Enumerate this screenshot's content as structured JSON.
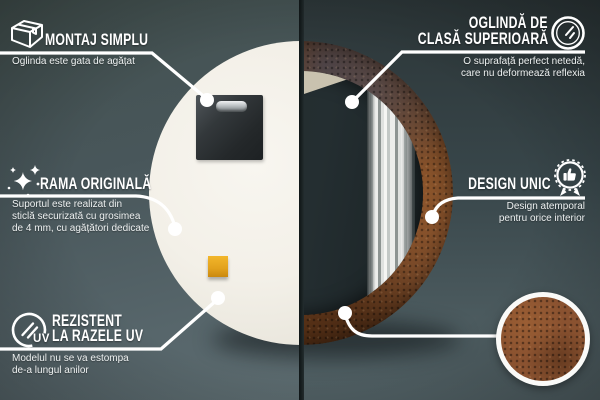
{
  "callouts": {
    "montaj": {
      "title": "MONTAJ SIMPLU",
      "desc": "Oglinda este gata de agățat",
      "icon": "package-box-icon"
    },
    "premium": {
      "title_line1": "OGLINDĂ DE",
      "title_line2": "CLASĂ SUPERIOARĂ",
      "desc_line1": "O suprafață perfect netedă,",
      "desc_line2": "care nu deformează reflexia",
      "icon": "mirror-shine-icon"
    },
    "rama": {
      "title": "RAMA ORIGINALĂ",
      "desc_line1": "Suportul este realizat din",
      "desc_line2": "sticlă securizată cu grosimea",
      "desc_line3": "de 4 mm, cu agățători dedicate",
      "icon": "sparkles-icon"
    },
    "design": {
      "title": "DESIGN UNIC",
      "desc_line1": "Design atemporal",
      "desc_line2": "pentru orice interior",
      "icon": "award-badge-icon"
    },
    "uv": {
      "title_line1": "REZISTENT",
      "title_line2": "LA RAZELE UV",
      "desc_line1": "Modelul nu se va estompa",
      "desc_line2": "de-a lungul anilor",
      "badge": "UV",
      "icon": "uv-sun-icon"
    }
  },
  "colors": {
    "callout_white": "#ffffff",
    "rust_frame": "#8a5230",
    "sticker_orange": "#e2a11c",
    "mirror_back_white": "#f3f0e8",
    "background_left": "#4d5c60",
    "background_right": "#38464a"
  }
}
